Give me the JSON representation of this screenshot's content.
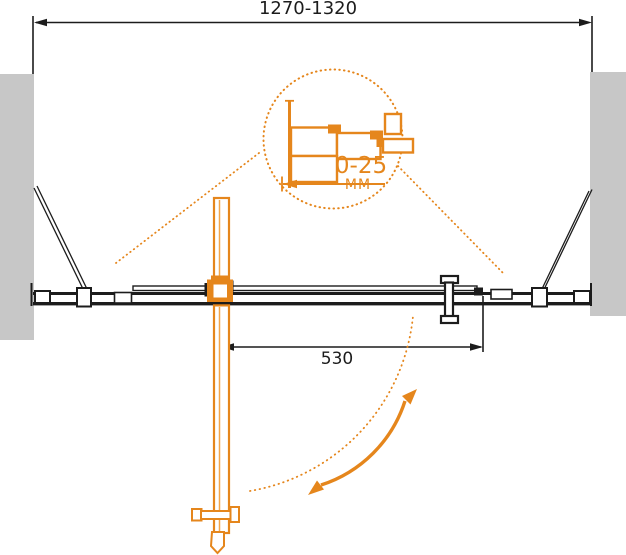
{
  "labels": {
    "overall_width": "1270-1320",
    "door_width": "530",
    "adjustment_range": "0-25",
    "adjustment_unit": "MM"
  },
  "colors": {
    "orange": "#E5861C",
    "orangeLight": "#F2A649",
    "ink": "#1C1C1C",
    "wall": "#C7C7C7",
    "bg": "#FFFFFF"
  }
}
